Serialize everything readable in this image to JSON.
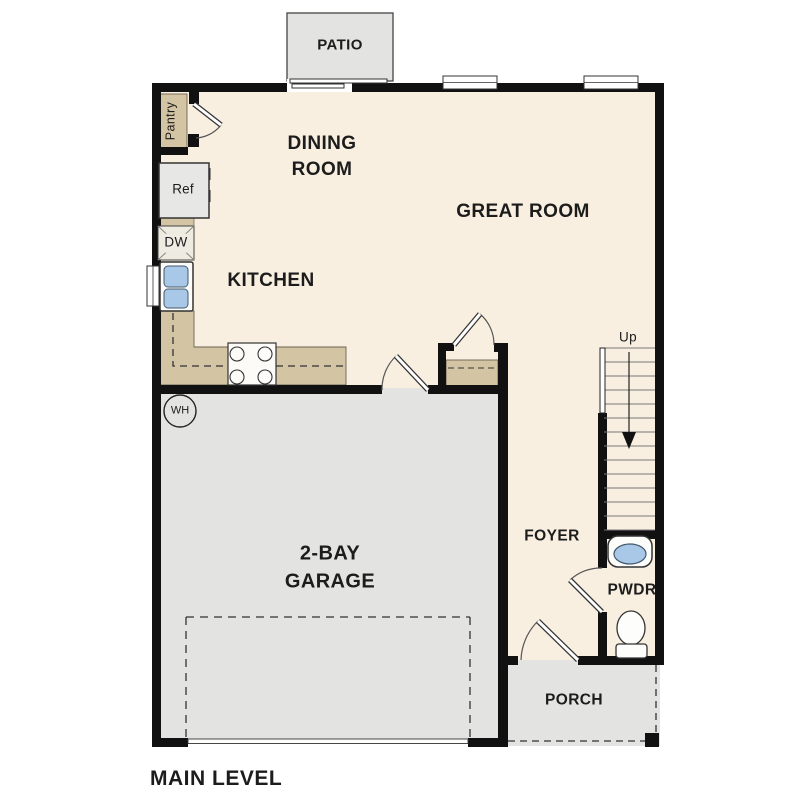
{
  "title": {
    "label": "MAIN LEVEL"
  },
  "rooms": {
    "patio": "PATIO",
    "dining_room": "DINING\nROOM",
    "great_room": "GREAT ROOM",
    "kitchen": "KITCHEN",
    "garage": "2-BAY\nGARAGE",
    "foyer": "FOYER",
    "powder_room": "PWDR",
    "porch": "PORCH"
  },
  "fixtures": {
    "pantry": "Pantry",
    "refrigerator": "Ref",
    "dishwasher": "DW",
    "water_heater": "WH",
    "stairs_direction": "Up"
  },
  "colors": {
    "floor": "#f9efe1",
    "garage_porch_patio": "#e3e3e1",
    "counter": "#d3c4a4",
    "fixture_blue": "#a9c7e6",
    "wall": "#111111"
  }
}
